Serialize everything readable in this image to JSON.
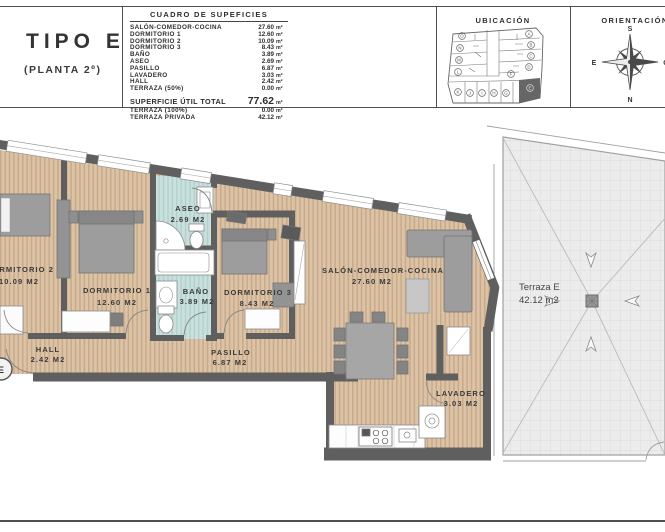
{
  "sheet": {
    "title": "TIPO E",
    "subtitle": "(PLANTA 2º)",
    "table": {
      "title": "CUADRO DE SUPEFICIES",
      "unit": "m²",
      "rows": [
        {
          "label": "SALÓN-COMEDOR-COCINA",
          "value": "27.60"
        },
        {
          "label": "DORMITORIO 1",
          "value": "12.60"
        },
        {
          "label": "DORMITORIO 2",
          "value": "10.09"
        },
        {
          "label": "DORMITORIO 3",
          "value": "8.43"
        },
        {
          "label": "BAÑO",
          "value": "3.89"
        },
        {
          "label": "ASEO",
          "value": "2.69"
        },
        {
          "label": "PASILLO",
          "value": "6.87"
        },
        {
          "label": "LAVADERO",
          "value": "3.03"
        },
        {
          "label": "HALL",
          "value": "2.42"
        },
        {
          "label": "TERRAZA (50%)",
          "value": "0.00"
        }
      ],
      "total": {
        "label": "SUPERFICIE ÚTIL TOTAL",
        "value": "77.62"
      },
      "total2": {
        "label": "TERRAZA (100%)",
        "value": "0.00"
      },
      "total3": {
        "label": "TERRAZA PRIVADA",
        "value": "42.12"
      }
    },
    "ubicacion": {
      "title": "UBICACIÓN",
      "units": [
        "O",
        "N",
        "M",
        "L",
        "A",
        "B",
        "C",
        "D",
        "K",
        "J",
        "I",
        "H",
        "G",
        "F",
        "E"
      ]
    },
    "orientacion": {
      "title": "ORIENTACIÓN",
      "south": "S",
      "north": "N",
      "east": "E",
      "west": "O"
    }
  },
  "plan": {
    "rooms": [
      {
        "name": "DORMITORIO 2",
        "area": "10.09 M2"
      },
      {
        "name": "DORMITORIO 1",
        "area": "12.60 M2"
      },
      {
        "name": "ASEO",
        "area": "2.69 M2"
      },
      {
        "name": "BAÑO",
        "area": "3.89 M2"
      },
      {
        "name": "DORMITORIO 3",
        "area": "8.43 M2"
      },
      {
        "name": "SALÓN-COMEDOR-COCINA",
        "area": "27.60 M2"
      },
      {
        "name": "HALL",
        "area": "2.42 M2"
      },
      {
        "name": "PASILLO",
        "area": "6.87 M2"
      },
      {
        "name": "LAVADERO",
        "area": "3.03 M2"
      }
    ],
    "terraza": {
      "name": "Terraza E",
      "area": "42.12 m2"
    },
    "entry_marker": "E"
  },
  "colors": {
    "wall": "#5f5f5f",
    "wood_floor": "#dcc3a6",
    "wet_floor": "#c9e0dd",
    "terrace_floor": "#ececec",
    "furniture": "#9d9d9d",
    "highlight_unit": "#666666",
    "text": "#3a3a3a"
  }
}
